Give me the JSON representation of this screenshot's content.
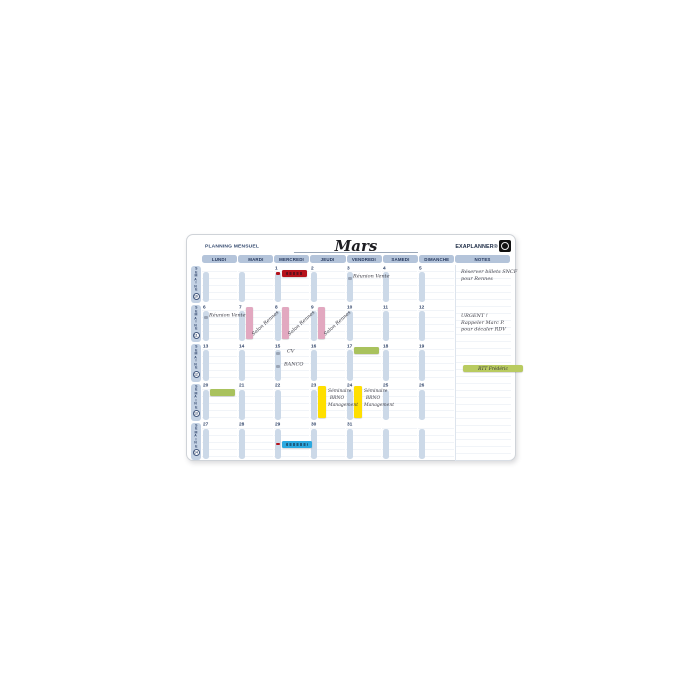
{
  "board": {
    "title_left": "PLANNING MENSUEL",
    "month": "Mars",
    "brand": "EXAPLANNER®",
    "logo_icon": "exacompta-logo",
    "week_label": "SEMAINE",
    "day_headers": [
      "LUNDI",
      "MARDI",
      "MERCREDI",
      "JEUDI",
      "VENDREDI",
      "SAMEDI",
      "DIMANCHE",
      "NOTES"
    ],
    "palette": {
      "header_pill": "#b4c4da",
      "date_strip": "#ccd9e8",
      "red": "#b5121b",
      "pink": "#e2a8c0",
      "green": "#a9c25d",
      "yellow": "#ffdf00",
      "blue": "#2ba9e0",
      "note_green": "#b9cb60",
      "text_navy": "#2f4368"
    },
    "weeks": [
      {
        "number": "10",
        "days": [
          {
            "num": "",
            "events": []
          },
          {
            "num": "",
            "events": []
          },
          {
            "num": "1",
            "events": [
              {
                "kind": "dot",
                "color": "red",
                "top": 7
              },
              {
                "kind": "hbar",
                "color": "red",
                "top": 5,
                "scribble": true
              }
            ]
          },
          {
            "num": "2",
            "events": []
          },
          {
            "num": "3",
            "events": [
              {
                "kind": "dot",
                "color": "#9aa5b5",
                "top": 12
              },
              {
                "kind": "script",
                "text": "Réunion Vente",
                "top": 9,
                "left": 7
              }
            ]
          },
          {
            "num": "4",
            "events": []
          },
          {
            "num": "5",
            "events": []
          }
        ]
      },
      {
        "number": "11",
        "days": [
          {
            "num": "6",
            "events": [
              {
                "kind": "dot",
                "color": "#9aa5b5",
                "top": 12
              },
              {
                "kind": "script",
                "text": "Réunion Vente",
                "top": 9,
                "left": 7
              }
            ]
          },
          {
            "num": "7",
            "events": [
              {
                "kind": "vbar",
                "color": "pink"
              },
              {
                "kind": "script",
                "text": "Salon Rennes",
                "top": 29,
                "left": 13,
                "rotate": -42
              }
            ]
          },
          {
            "num": "8",
            "events": [
              {
                "kind": "vbar",
                "color": "pink"
              },
              {
                "kind": "script",
                "text": "Salon Rennes",
                "top": 29,
                "left": 13,
                "rotate": -42
              }
            ]
          },
          {
            "num": "9",
            "events": [
              {
                "kind": "vbar",
                "color": "pink"
              },
              {
                "kind": "script",
                "text": "Salon Rennes",
                "top": 29,
                "left": 13,
                "rotate": -42
              }
            ]
          },
          {
            "num": "10",
            "events": []
          },
          {
            "num": "11",
            "events": []
          },
          {
            "num": "12",
            "events": []
          }
        ]
      },
      {
        "number": "12",
        "days": [
          {
            "num": "13",
            "events": []
          },
          {
            "num": "14",
            "events": []
          },
          {
            "num": "15",
            "events": [
              {
                "kind": "dot",
                "color": "#9aa5b5",
                "top": 9
              },
              {
                "kind": "script",
                "text": "CV",
                "top": 6,
                "left": 13
              },
              {
                "kind": "dot",
                "color": "#9aa5b5",
                "top": 22
              },
              {
                "kind": "script",
                "text": "BANCO",
                "top": 19,
                "left": 10
              }
            ]
          },
          {
            "num": "16",
            "events": []
          },
          {
            "num": "17",
            "events": [
              {
                "kind": "hbar",
                "color": "green",
                "top": 4
              }
            ]
          },
          {
            "num": "18",
            "events": []
          },
          {
            "num": "19",
            "events": []
          }
        ]
      },
      {
        "number": "13",
        "days": [
          {
            "num": "20",
            "events": [
              {
                "kind": "hbar",
                "color": "green",
                "top": 6
              }
            ]
          },
          {
            "num": "21",
            "events": []
          },
          {
            "num": "22",
            "events": []
          },
          {
            "num": "23",
            "events": [
              {
                "kind": "vbar",
                "color": "yellow",
                "wide": true
              },
              {
                "kind": "lines",
                "lines": [
                  "Séminaire",
                  "BRNO",
                  "Management"
                ],
                "top": 4,
                "left": 18
              }
            ]
          },
          {
            "num": "24",
            "events": [
              {
                "kind": "vbar",
                "color": "yellow",
                "wide": true
              },
              {
                "kind": "lines",
                "lines": [
                  "Séminaire",
                  "BRNO",
                  "Management"
                ],
                "top": 4,
                "left": 18
              }
            ]
          },
          {
            "num": "25",
            "events": []
          },
          {
            "num": "26",
            "events": []
          }
        ]
      },
      {
        "number": "14",
        "days": [
          {
            "num": "27",
            "events": []
          },
          {
            "num": "28",
            "events": []
          },
          {
            "num": "29",
            "events": [
              {
                "kind": "dot",
                "color": "red",
                "top": 21
              },
              {
                "kind": "hbar",
                "color": "blue",
                "top": 19,
                "right": -3,
                "scribble": true
              }
            ]
          },
          {
            "num": "30",
            "events": []
          },
          {
            "num": "31",
            "events": []
          },
          {
            "num": "",
            "events": []
          },
          {
            "num": "",
            "events": []
          }
        ]
      }
    ],
    "notes": [
      {
        "kind": "lines",
        "lines": [
          "Réserver billets SNCF",
          "pour Rennes"
        ],
        "top": 3
      },
      {
        "kind": "lines",
        "lines": [
          "URGENT !",
          "Rappeler Marc P.",
          "pour décaler RDV"
        ],
        "top": 47
      },
      {
        "kind": "magnet",
        "color": "note_green",
        "text": "RTT Frédéric",
        "top": 100
      }
    ]
  }
}
